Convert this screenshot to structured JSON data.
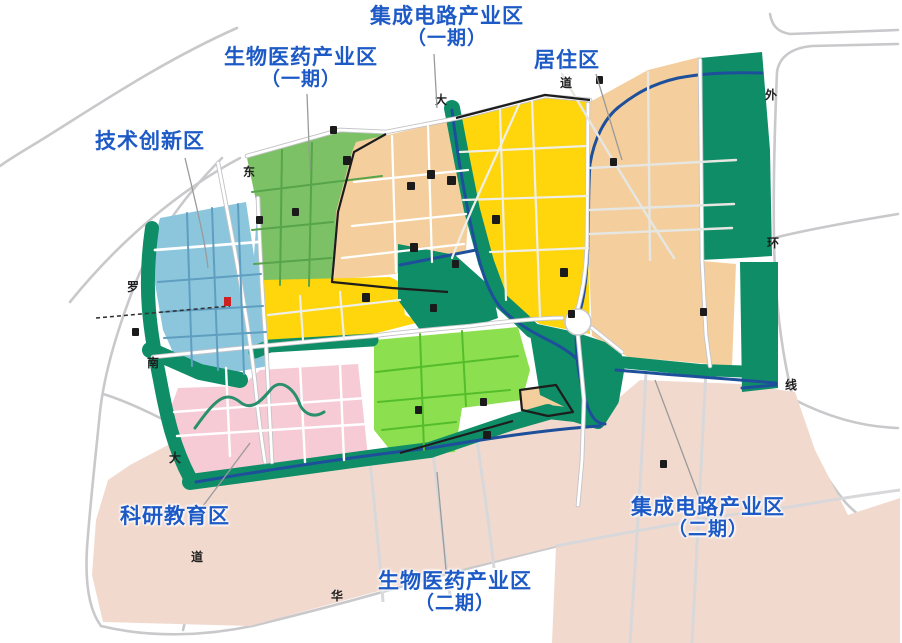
{
  "map": {
    "callouts": [
      {
        "id": "ic-phase1",
        "line1": "集成电路产业区",
        "line2": "（一期）"
      },
      {
        "id": "bio-phase1",
        "line1": "生物医药产业区",
        "line2": "（一期）"
      },
      {
        "id": "residential",
        "line1": "居住区",
        "line2": ""
      },
      {
        "id": "tech-innovation",
        "line1": "技术创新区",
        "line2": ""
      },
      {
        "id": "research-education",
        "line1": "科研教育区",
        "line2": ""
      },
      {
        "id": "bio-phase2",
        "line1": "生物医药产业区",
        "line2": "（二期）"
      },
      {
        "id": "ic-phase2",
        "line1": "集成电路产业区",
        "line2": "（二期）"
      }
    ],
    "road_labels": [
      {
        "text": "东"
      },
      {
        "text": "大"
      },
      {
        "text": "道"
      },
      {
        "text": "外"
      },
      {
        "text": "环"
      },
      {
        "text": "线"
      },
      {
        "text": "罗"
      },
      {
        "text": "南"
      },
      {
        "text": "大"
      },
      {
        "text": "道"
      },
      {
        "text": "华"
      }
    ],
    "zones": [
      {
        "name": "技术创新区",
        "color": "#8cc6dd"
      },
      {
        "name": "生物医药产业区（一期）",
        "color": "#7cc166"
      },
      {
        "name": "集成电路产业区（一期）",
        "color": "#ffd60b"
      },
      {
        "name": "居住区",
        "color": "#f4cf9d"
      },
      {
        "name": "科研教育区",
        "color": "#f6cbd5"
      },
      {
        "name": "生物医药产业区（二期）",
        "color": "#8ce04f"
      },
      {
        "name": "集成电路产业区（二期）",
        "color": "#f2d9ce"
      }
    ],
    "colors": {
      "label_blue": "#1e5ac6",
      "greenbelt": "#0f8d66",
      "river": "#1e4f9b",
      "road_gray": "#c9c9cc",
      "boundary_black": "#1d1d1d"
    }
  }
}
